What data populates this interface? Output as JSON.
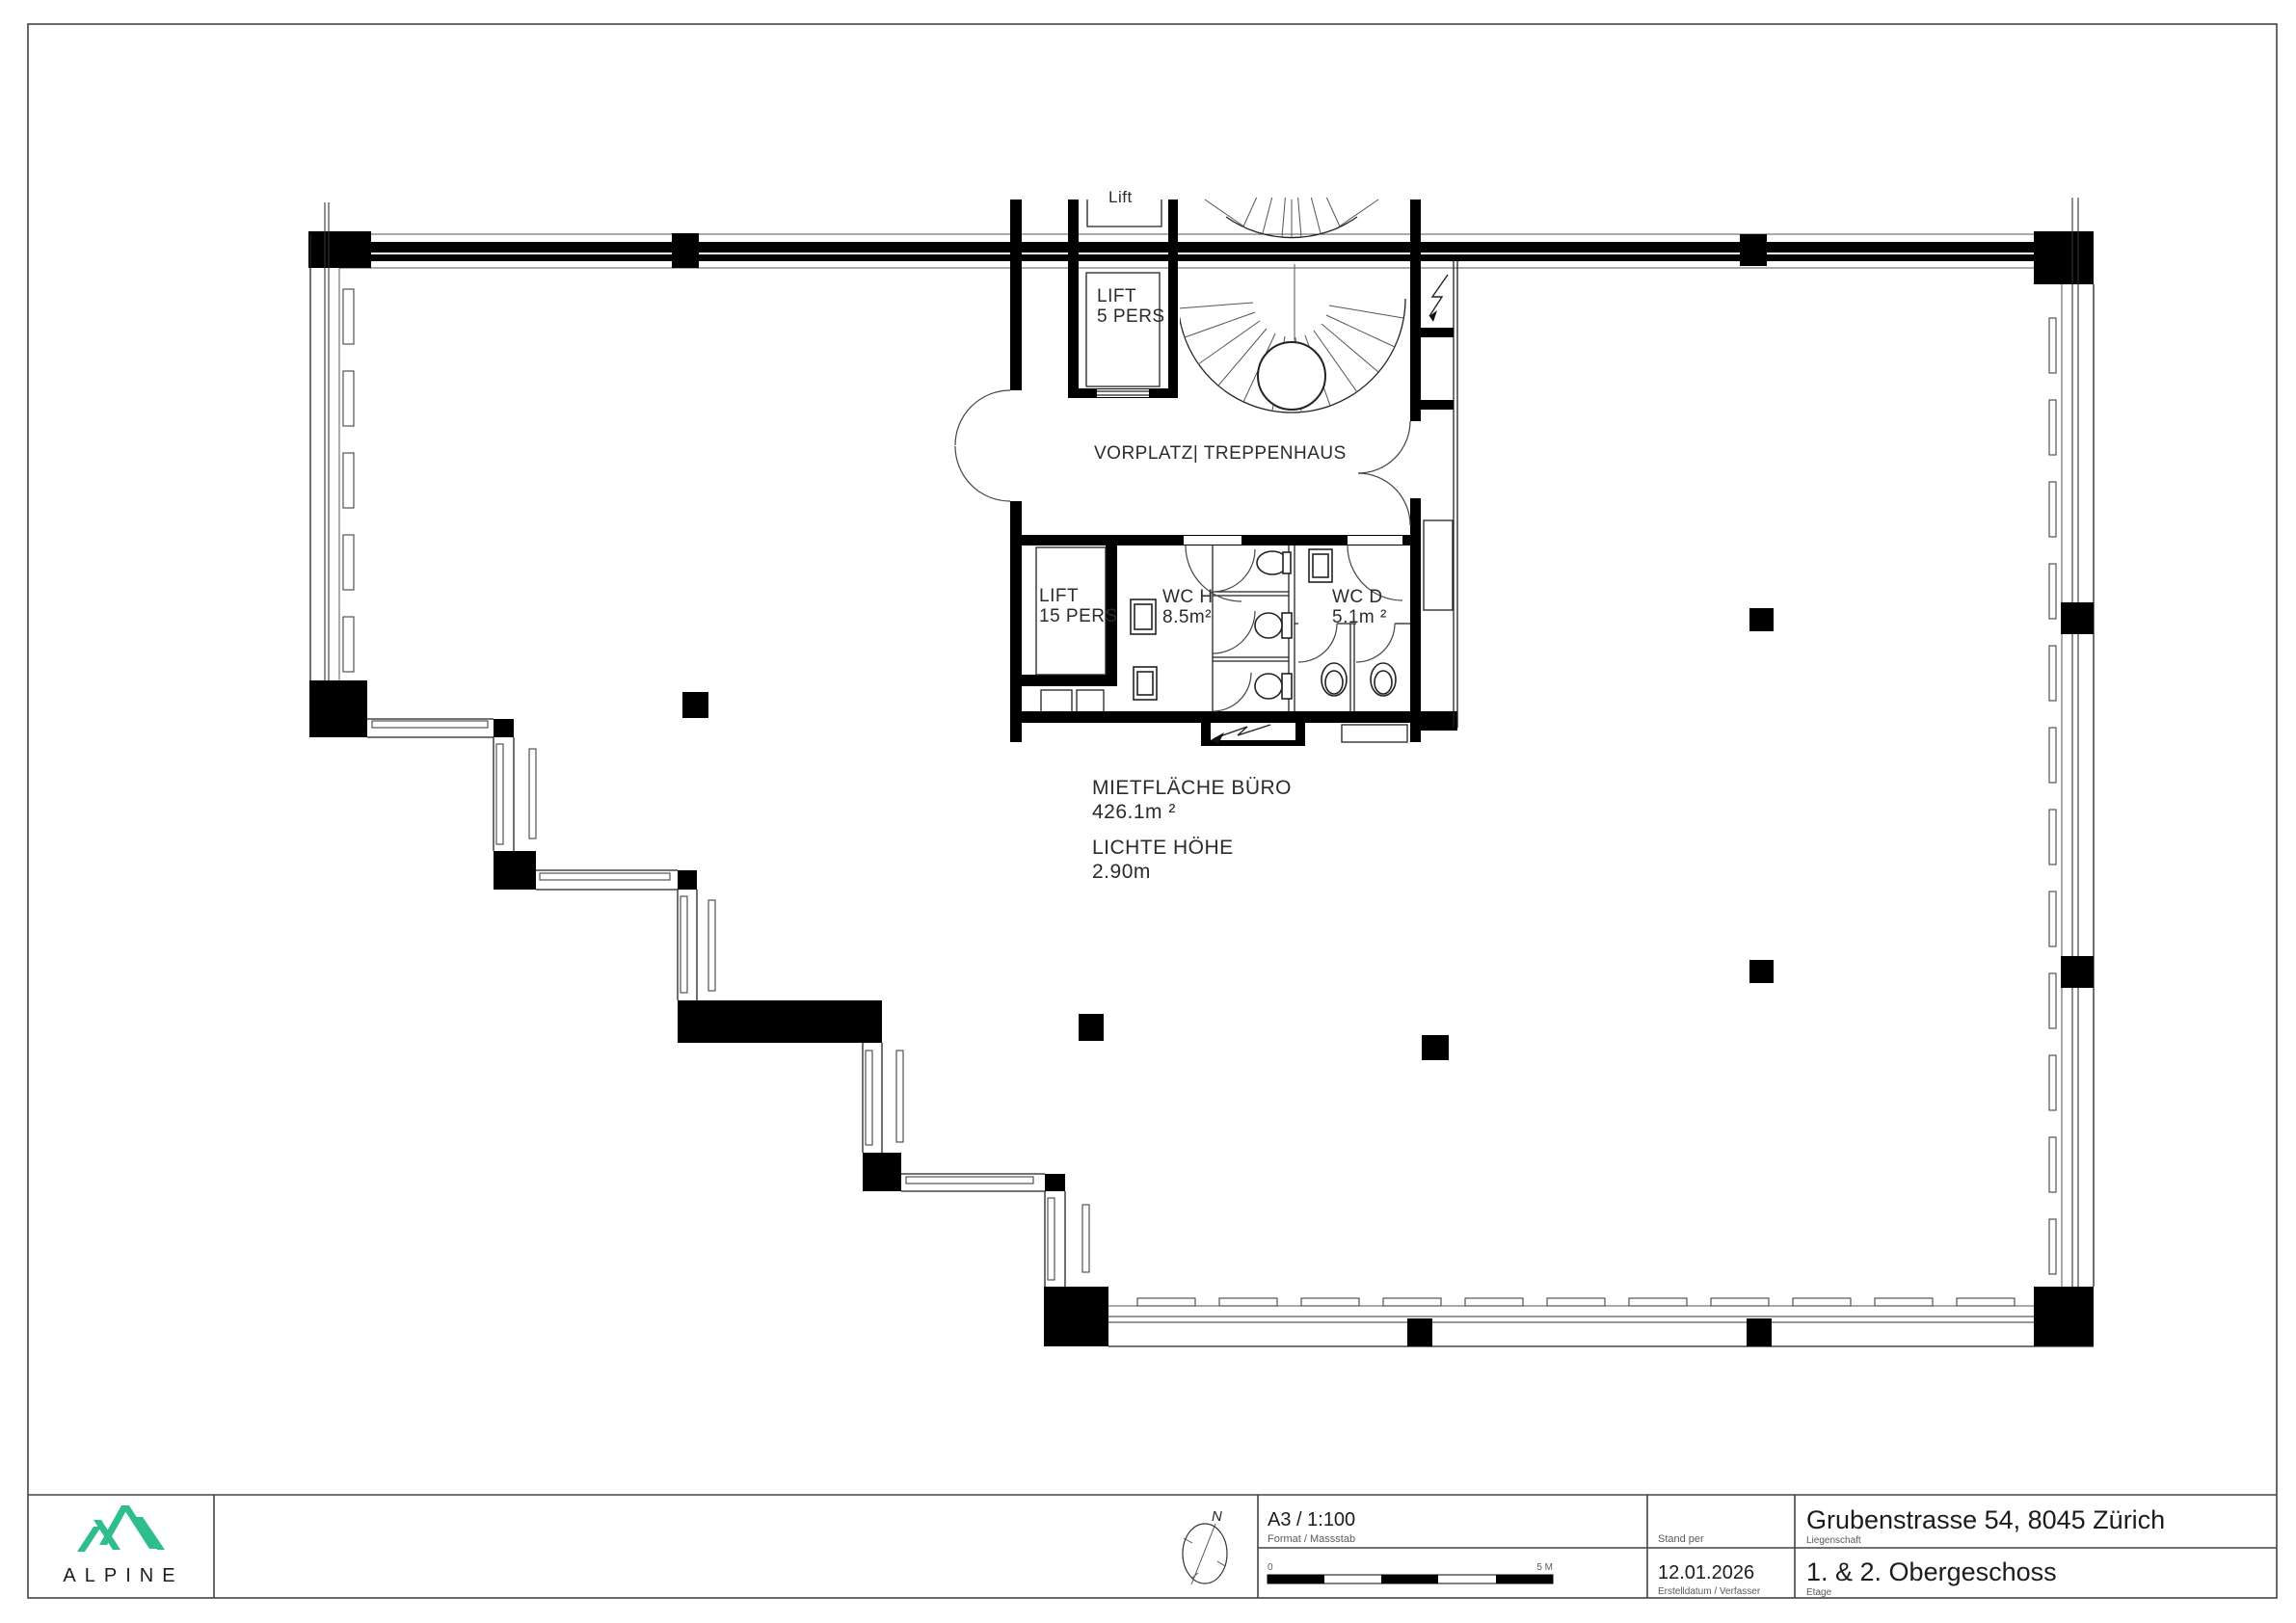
{
  "colors": {
    "accent": "#2ebd8c",
    "ink": "#111111"
  },
  "plan": {
    "labels": {
      "lift_top": "Lift",
      "lift5_line1": "LIFT",
      "lift5_line2": "5 PERS",
      "vorplatz": "VORPLATZ|  TREPPENHAUS",
      "lift15_line1": "LIFT",
      "lift15_line2": "15 PERS",
      "wch_line1": "WC H",
      "wch_line2": "8.5m²",
      "wcd_line1": "WC D",
      "wcd_line2": "5.1m ²",
      "area_title": "MIETFLÄCHE BÜRO",
      "area_value": "426.1m ²",
      "height_title": "LICHTE HÖHE",
      "height_value": "2.90m"
    }
  },
  "titleblock": {
    "logo_text": "ALPINE",
    "compass_n": "N",
    "format_value": "A3 / 1:100",
    "format_label": "Format / Massstab",
    "scale_zero": "0",
    "scale_max": "5 M",
    "date_label": "Stand per",
    "date_value": "12.01.2026",
    "date_sublabel": "Erstelldatum / Verfasser",
    "property_value": "Grubenstrasse 54, 8045 Zürich",
    "property_label": "Liegenschaft",
    "floor_value": "1. & 2. Obergeschoss",
    "floor_label": "Etage"
  }
}
